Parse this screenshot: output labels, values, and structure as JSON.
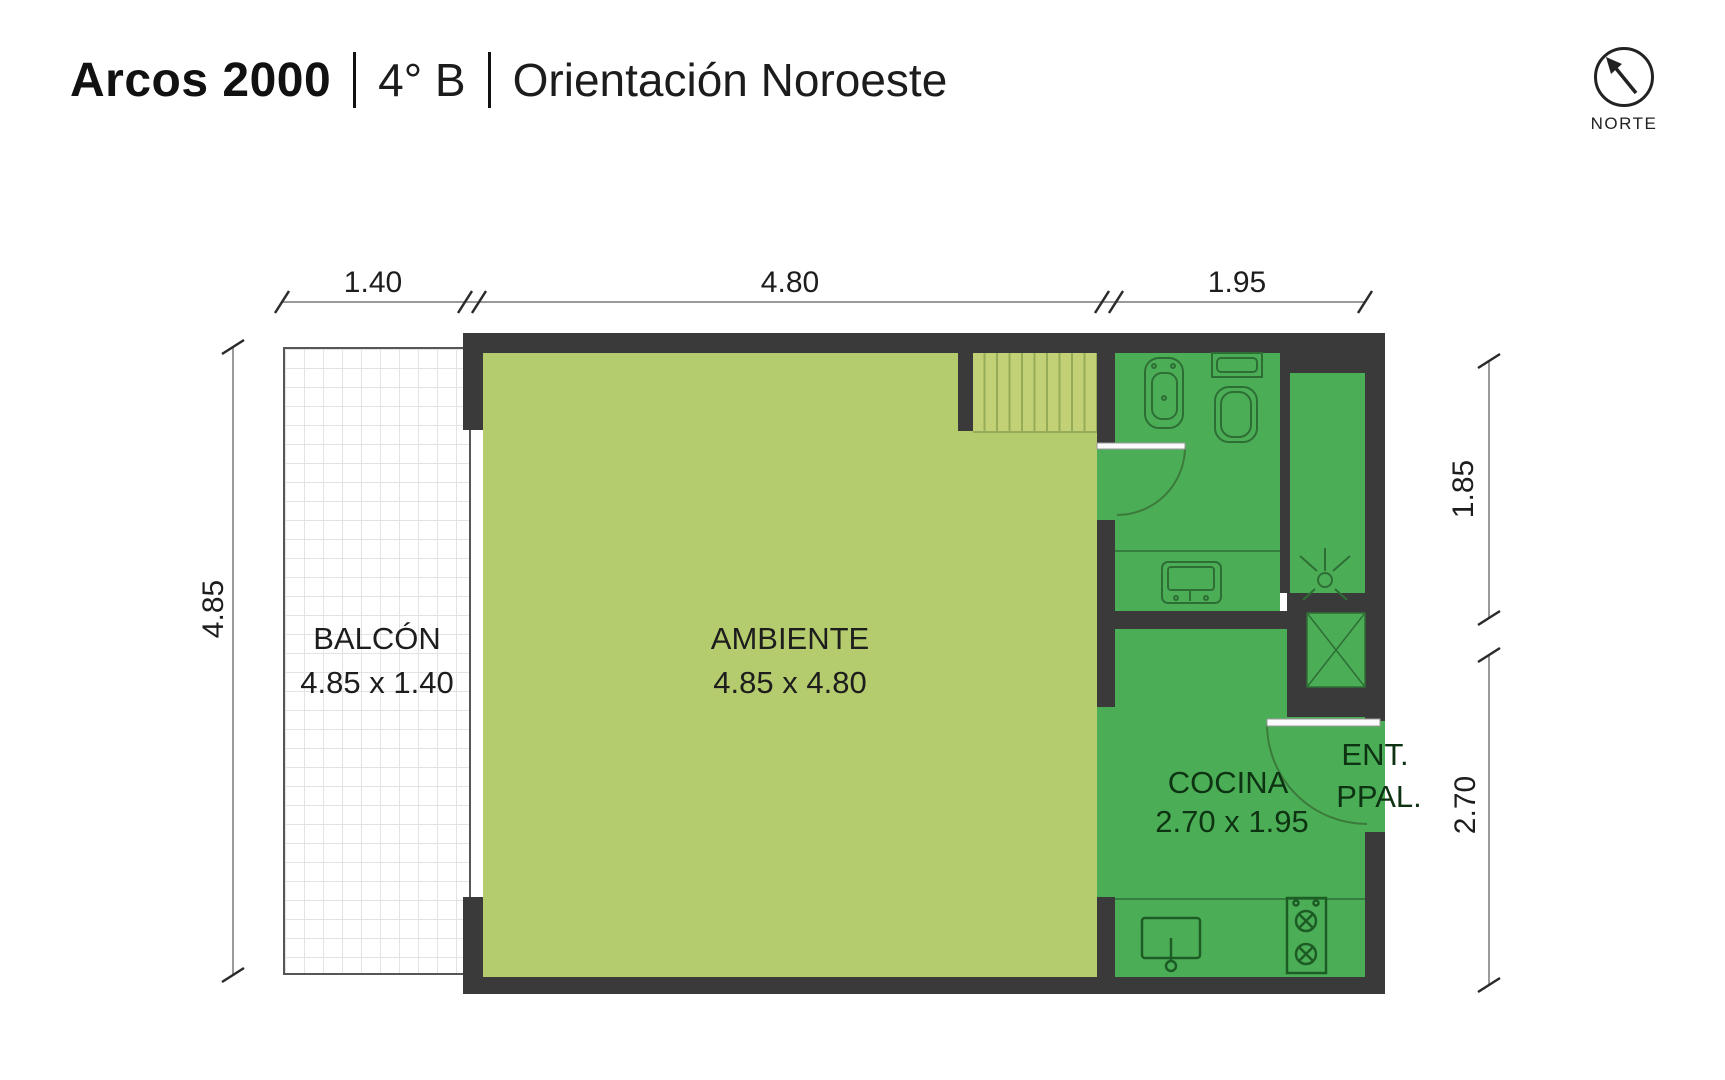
{
  "title": {
    "brand": "Arcos 2000",
    "separator": "",
    "unit": "4° B",
    "orientation": "Orientación Noroeste"
  },
  "north": {
    "label": "NORTE"
  },
  "dims": {
    "top": [
      "1.40",
      "4.80",
      "1.95"
    ],
    "left": "4.85",
    "right_top": "1.85",
    "right_bottom": "2.70"
  },
  "rooms": {
    "balcony": {
      "name": "BALCÓN",
      "size": "4.85 x 1.40"
    },
    "living": {
      "name": "AMBIENTE",
      "size": "4.85 x 4.80"
    },
    "kitchen": {
      "name": "COCINA",
      "size": "2.70 x 1.95"
    },
    "entrance": {
      "line1": "ENT.",
      "line2": "PPAL."
    }
  },
  "colors": {
    "wall": "#3a3a3a",
    "living": "#b5cc6e",
    "service": "#4bae57",
    "stair-bg": "#c2d176",
    "stair-stripe": "#96ab57",
    "fixture": "#2e6e35",
    "dim-line": "#9a9a9a",
    "text": "#1d1d1d",
    "ktext": "#0e3312"
  }
}
